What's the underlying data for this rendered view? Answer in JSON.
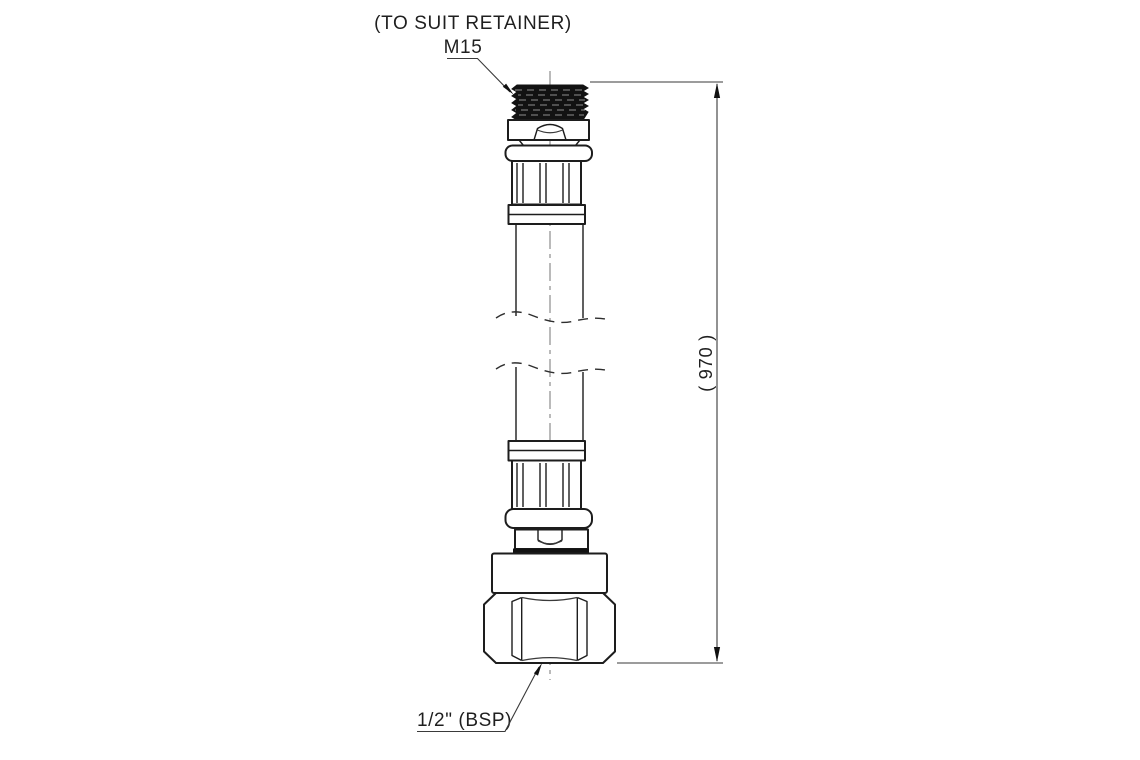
{
  "canvas": {
    "background": "#ffffff",
    "width": 1140,
    "height": 760
  },
  "drawing": {
    "kind": "technical-drawing-flexible-hose-connector",
    "ink_color": "#1d1d1d",
    "thin_line_color": "#3a3a3a",
    "centerline_color": "#8c8c8c",
    "labels": {
      "top_note_line1": "(TO SUIT RETAINER)",
      "top_note_line2": "M15",
      "length_dimension": "( 970 )",
      "bottom_note": "1/2\" (BSP)"
    }
  }
}
